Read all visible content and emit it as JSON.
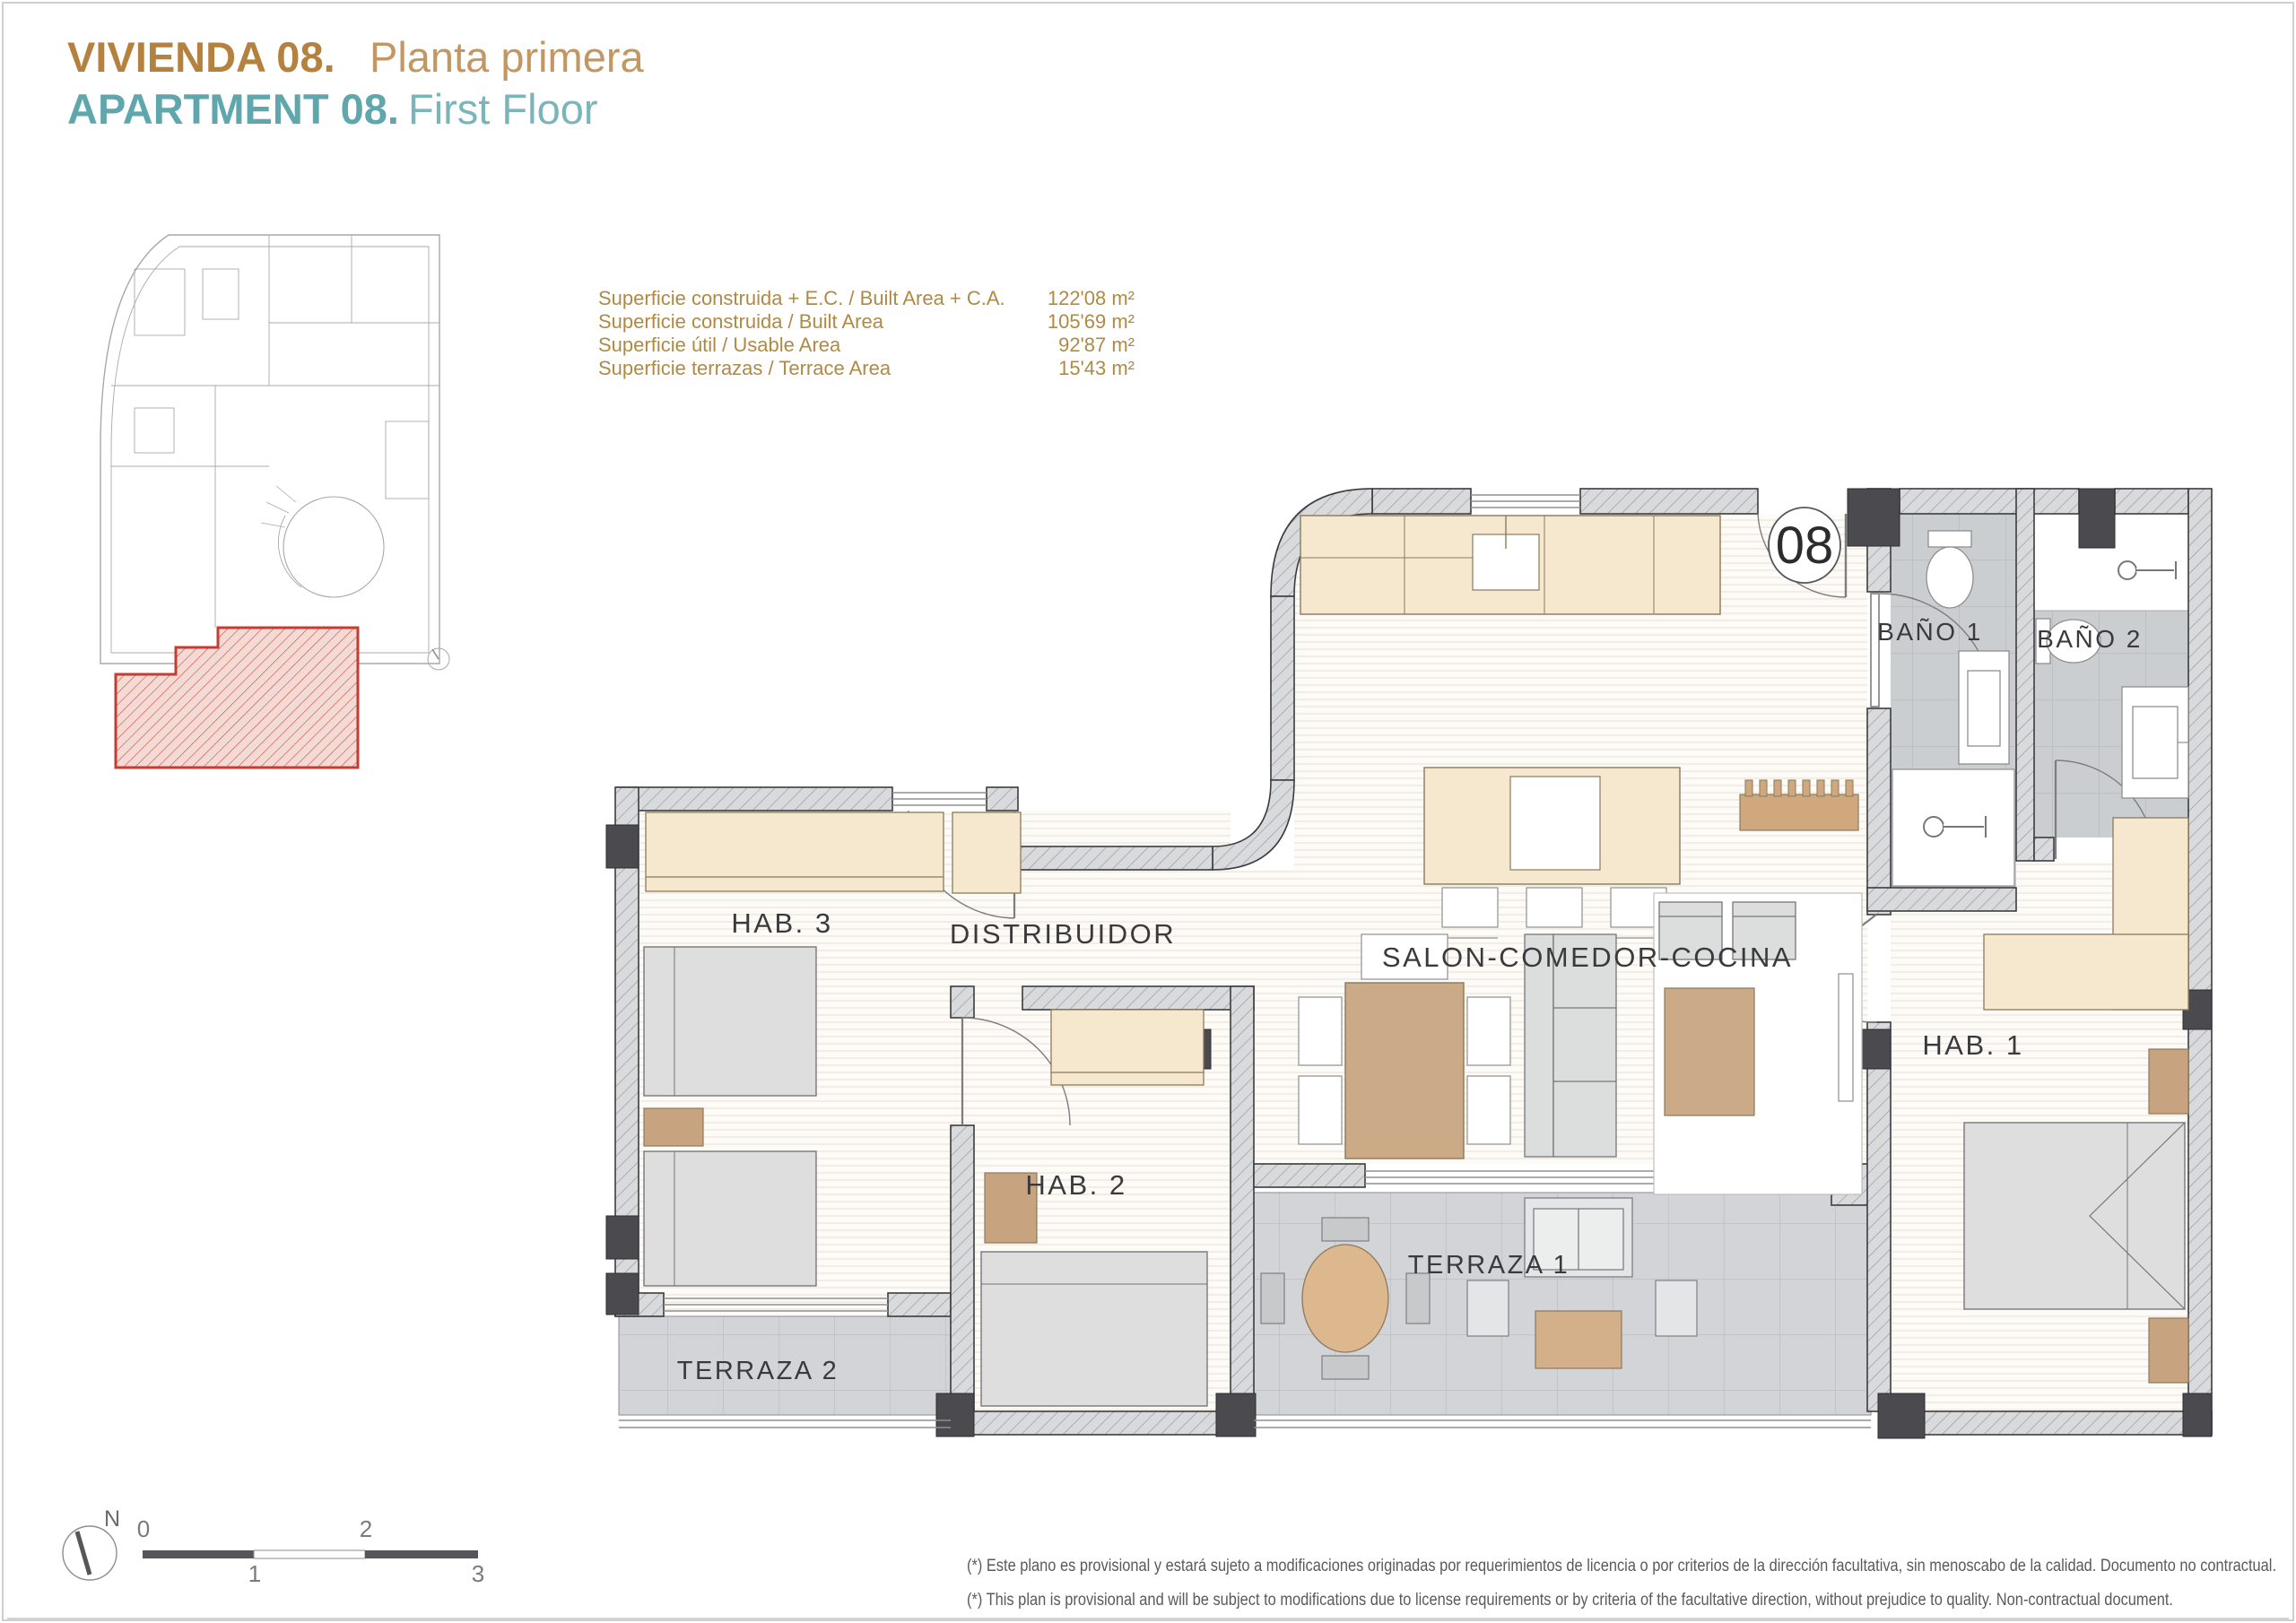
{
  "page": {
    "title_line1": {
      "bold": "VIVIENDA 08.",
      "light": "Planta primera"
    },
    "title_line2": {
      "bold": "APARTMENT 08.",
      "light": "First Floor"
    },
    "accent_gold": "#b5813f",
    "accent_teal": "#5fa7ac",
    "highlight_red": "#c43c32"
  },
  "area_table": {
    "rows": [
      {
        "label": "Superficie construida + E.C. / Built Area + C.A.",
        "value": "122'08 m²"
      },
      {
        "label": "Superficie construida / Built Area",
        "value": "105'69 m²"
      },
      {
        "label": "Superficie útil / Usable Area",
        "value": "92'87 m²"
      },
      {
        "label": "Superficie terrazas / Terrace Area",
        "value": "15'43 m²"
      }
    ]
  },
  "plan": {
    "apartment_number": "08",
    "rooms": {
      "salon": "SALON-COMEDOR-COCINA",
      "distribuidor": "DISTRIBUIDOR",
      "hab1": "HAB. 1",
      "hab2": "HAB. 2",
      "hab3": "HAB. 3",
      "bano1": "BAÑO 1",
      "bano2": "BAÑO 2",
      "terraza1": "TERRAZA 1",
      "terraza2": "TERRAZA 2"
    }
  },
  "scale_bar": {
    "north": "N",
    "tick0": "0",
    "tick1": "1",
    "tick2": "2",
    "tick3": "3"
  },
  "footnotes": {
    "es": "(*) Este plano es provisional y estará sujeto a modificaciones originadas por requerimientos de licencia o por criterios de la dirección facultativa, sin menoscabo de la calidad. Documento no contractual.",
    "en": "(*) This plan is provisional and will be subject to modifications due to license requirements or by criteria of the facultative direction, without prejudice to quality. Non-contractual document."
  }
}
